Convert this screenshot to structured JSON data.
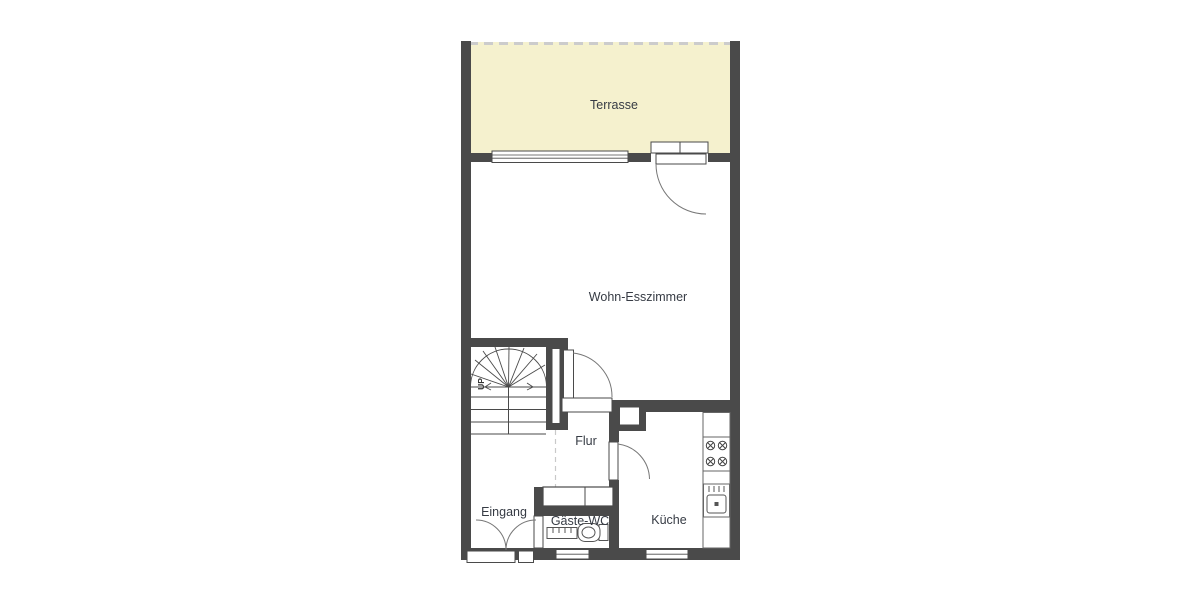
{
  "rooms": {
    "terrasse": "Terrasse",
    "wohn_esszimmer": "Wohn-Esszimmer",
    "flur": "Flur",
    "eingang": "Eingang",
    "gaeste_wc": "Gäste-WC",
    "kueche": "Küche"
  },
  "stairs": {
    "direction_label": "UP"
  },
  "colors": {
    "wall": "#4a4a4a",
    "terrace_fill": "#f5f1ce",
    "dashed_line": "#cccccc",
    "label_text": "#363b44",
    "fixture_line": "#555555",
    "background": "#ffffff"
  }
}
